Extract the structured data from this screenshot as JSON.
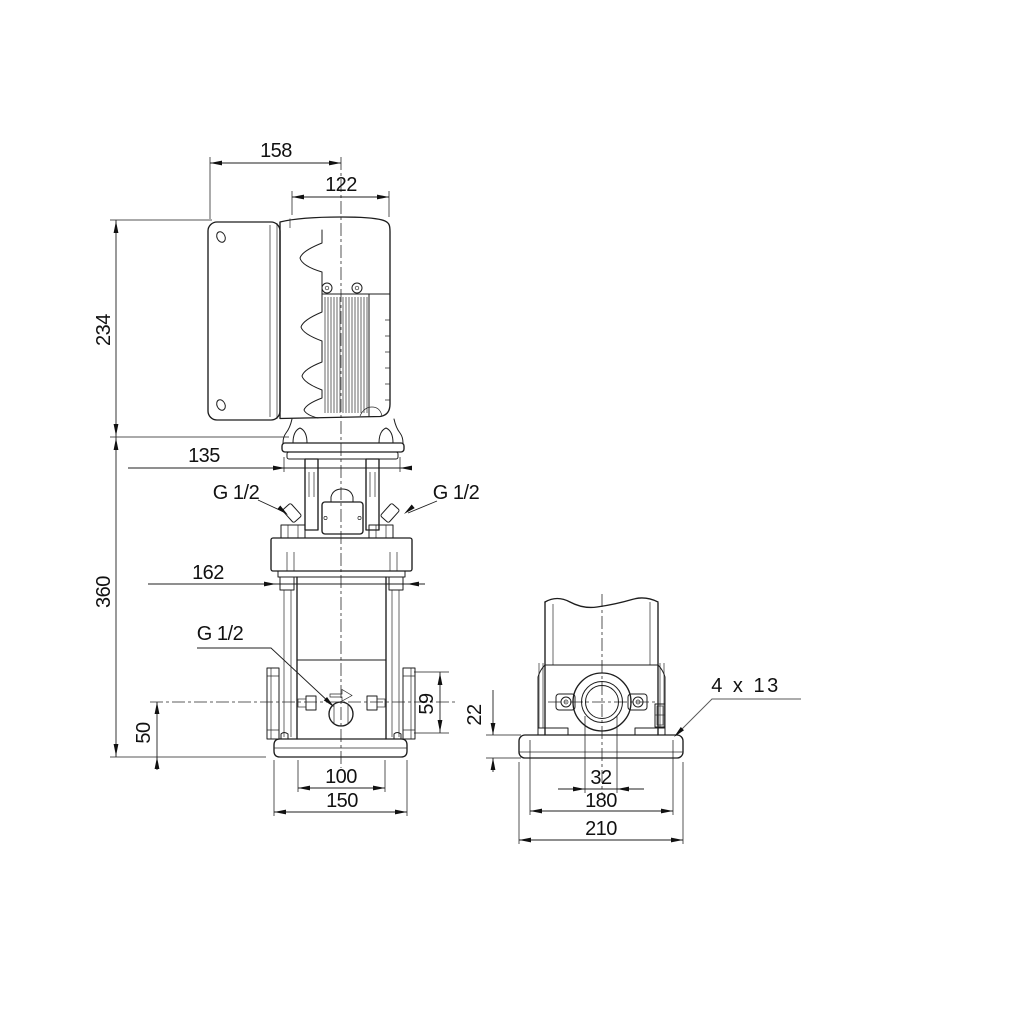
{
  "drawing": {
    "background": "#ffffff",
    "line_color": "#1d1d1d",
    "front_view": {
      "overall_width": "158",
      "motor_width": "122",
      "motor_height": "234",
      "coupling_width": "135",
      "pump_height": "360",
      "port_face_width": "162",
      "port_center_height": "50",
      "port_flange_height": "59",
      "base_hole_spacing": "100",
      "base_width": "150",
      "vent_plug_left": "G 1/2",
      "vent_plug_right": "G 1/2",
      "drain_plug": "G 1/2"
    },
    "side_view": {
      "base_plate_thickness": "22",
      "port_bore": "32",
      "base_hole_spacing": "180",
      "base_width": "210",
      "mounting_holes": "4 x 13"
    }
  }
}
